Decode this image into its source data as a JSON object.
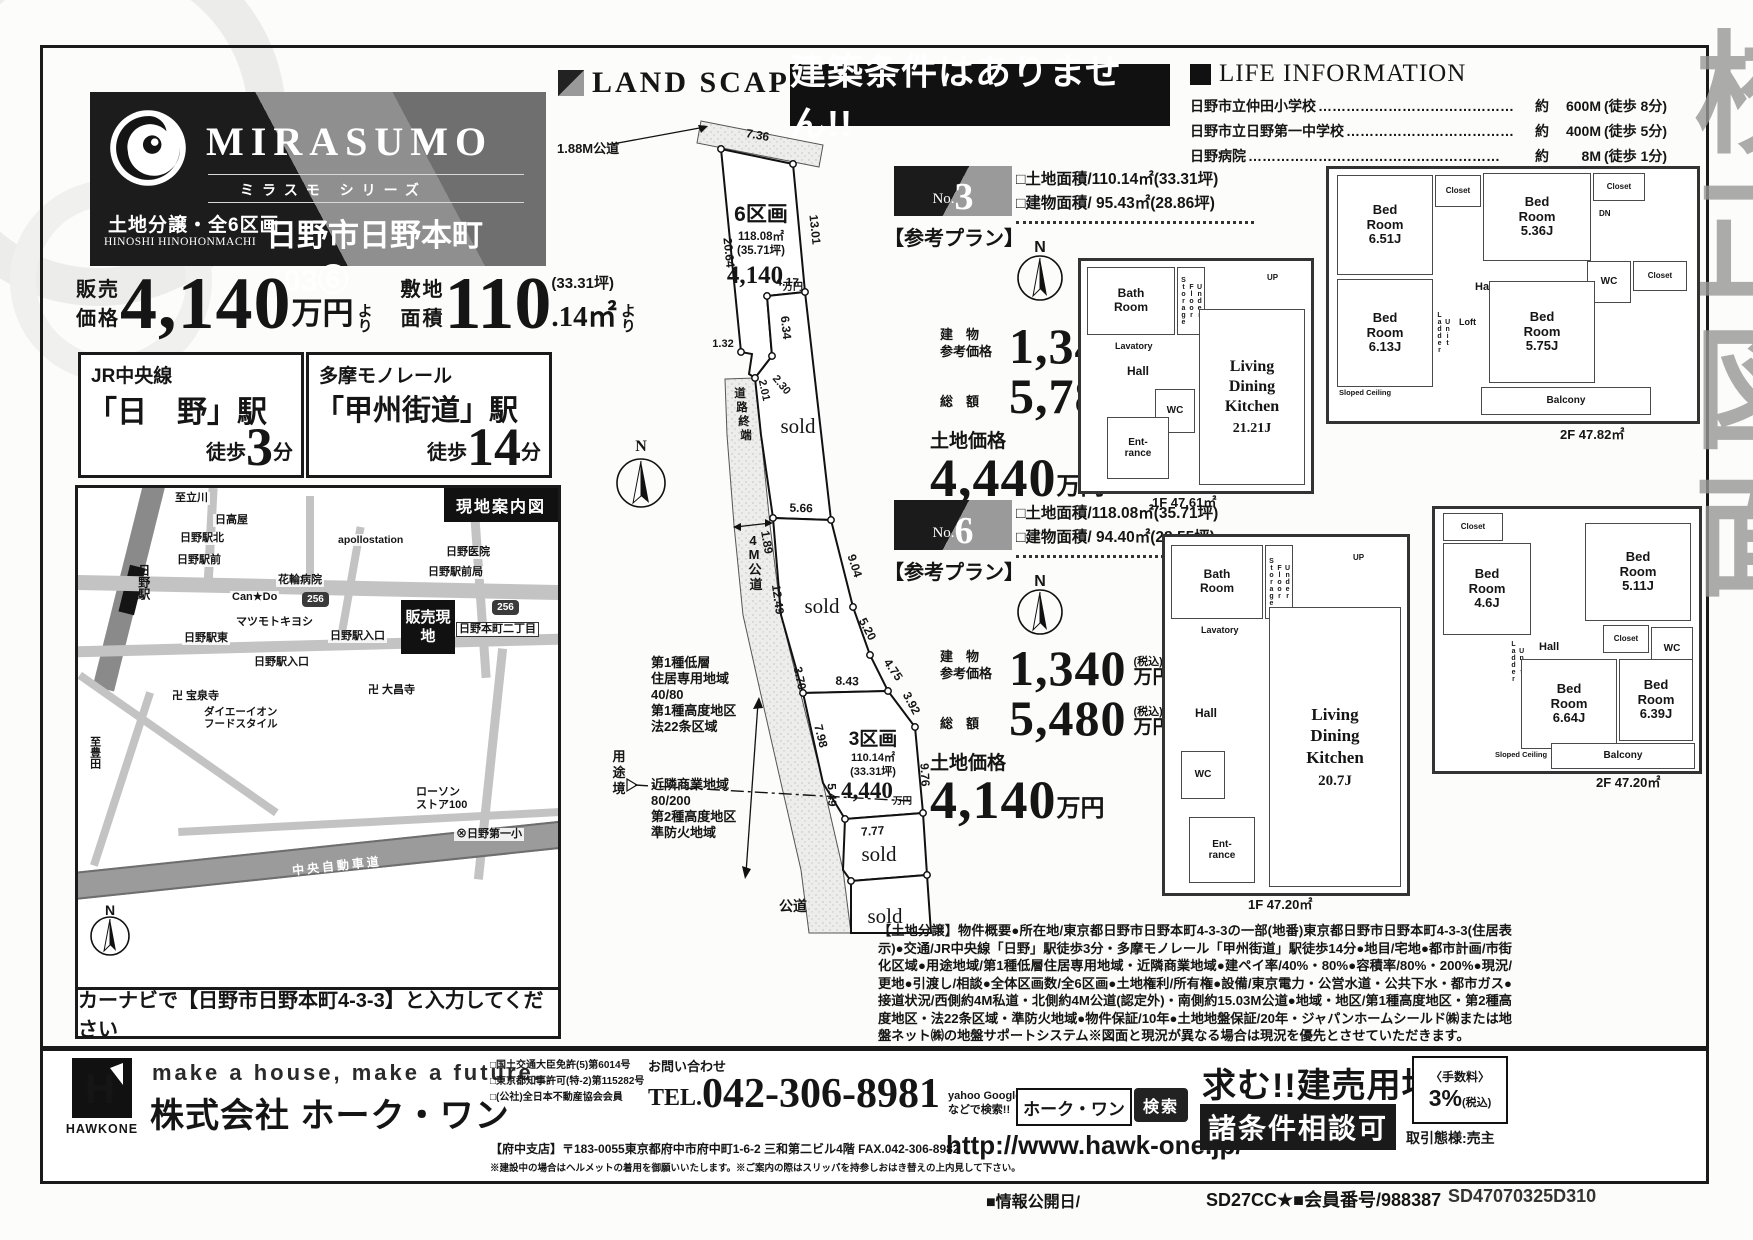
{
  "watermark": {
    "chars": [
      "校",
      "正",
      "図",
      "面"
    ]
  },
  "brand": {
    "name": "MIRASUMO",
    "series": "ミラスモ シリーズ",
    "sale_type": "土地分譲・全6区画",
    "romaji": "HINOSHI HINOHONMACHI",
    "property": "日野市日野本町403⑥"
  },
  "pricing": {
    "price_label": "販売\n価格",
    "price_value": "4,140",
    "price_unit": "万円",
    "price_suffix": "より",
    "area_label": "敷地\n面積",
    "area_value": "110",
    "area_tsubo": "(33.31坪)",
    "area_decimal": ".14㎡",
    "area_suffix": "より"
  },
  "access": [
    {
      "line": "JR中央線",
      "station": "「日　野」駅",
      "walk_prefix": "徒歩",
      "walk_num": "3",
      "walk_suffix": "分"
    },
    {
      "line": "多摩モノレール",
      "station": "「甲州街道」駅",
      "walk_prefix": "徒歩",
      "walk_num": "14",
      "walk_suffix": "分"
    }
  ],
  "map": {
    "title": "現地案内図",
    "site": "販売現地",
    "route_number": "256",
    "compass_n": "N",
    "caption": "カーナビで【日野市日野本町4-3-3】と入力してください",
    "labels": [
      "至立川",
      "日高屋",
      "日野駅北",
      "日野駅前",
      "apollostation",
      "日野医院",
      "花輪病院",
      "日野駅前局",
      "Can★Do",
      "マツモトキヨシ",
      "日野駅東",
      "日野駅入口",
      "日野本町二丁目",
      "日野駅入口",
      "卍 宝泉寺",
      "卍 大昌寺",
      "ダイエーイオン\nフードスタイル",
      "至豊田",
      "ローソン\nストア100",
      "⊗日野第一小",
      "中央自動車道",
      "日野駅"
    ]
  },
  "landscape": {
    "title": "LAND SCAPE",
    "compass_n": "N",
    "road_188": "1.88M公道",
    "road_end": [
      "道",
      "路",
      "終",
      "端"
    ],
    "road_4m": [
      "4",
      "M",
      "公",
      "道"
    ],
    "boundary": [
      "用",
      "途",
      "境"
    ],
    "public_road": "公道",
    "sold": "sold",
    "zone_north": [
      "第1種低層",
      "住居専用地域",
      "40/80",
      "第1種高度地区",
      "法22条区域"
    ],
    "zone_south": [
      "近隣商業地域",
      "80/200",
      "第2種高度地区",
      "準防火地域"
    ],
    "plot6": {
      "name": "6区画",
      "area": "118.08㎡",
      "tsubo": "(35.71坪)",
      "price": "4,140",
      "unit": "万円"
    },
    "plot3": {
      "name": "3区画",
      "area": "110.14㎡",
      "tsubo": "(33.31坪)",
      "price": "4,440",
      "unit": "万円"
    },
    "dims": {
      "d736": "7.36",
      "d2064": "20.64",
      "d1301": "13.01",
      "d417": "4.17",
      "d634": "6.34",
      "d132": "1.32",
      "d201": "2.01",
      "d230": "2.30",
      "d566": "5.66",
      "d189": "1.89",
      "d904": "9.04",
      "d1249": "12.49",
      "d520": "5.20",
      "d475": "4.75",
      "d392": "3.92",
      "d370": "3.70",
      "d843": "8.43",
      "d798": "7.98",
      "d549": "5.49",
      "d976": "9.76",
      "d777": "7.77"
    }
  },
  "banner": "建築条件はありません!!",
  "life_info": {
    "title": "LIFE INFORMATION",
    "items": [
      {
        "name": "日野市立仲田小学校",
        "dots": "……………………………………",
        "approx": "約",
        "dist": "600M",
        "walk": "(徒歩 8分)"
      },
      {
        "name": "日野市立日野第一中学校",
        "dots": "………………………………",
        "approx": "約",
        "dist": "400M",
        "walk": "(徒歩 5分)"
      },
      {
        "name": "日野病院",
        "dots": "………………………………………………",
        "approx": "約",
        "dist": "8M",
        "walk": "(徒歩 1分)"
      }
    ]
  },
  "plans": [
    {
      "no_prefix": "No.",
      "no": "3",
      "ref": "【参考プラン】",
      "land_area": "□土地面積/110.14㎡(33.31坪)",
      "building_area": "□建物面積/ 95.43㎡(28.86坪)",
      "bp_label": "建　物\n参考価格",
      "bp_value": "1,340",
      "bp_tax": "(税込)",
      "bp_unit": "万円",
      "tp_label": "総　額",
      "tp_value": "5,780",
      "tp_tax": "(税込)",
      "tp_unit": "万円",
      "lp_label": "土地価格",
      "lp_value": "4,440",
      "lp_unit": "万円",
      "f1": "1F 47.61㎡",
      "f2": "2F 47.82㎡",
      "r1": {
        "bath": "Bath\nRoom",
        "storage": "Under Floor Storage",
        "lavatory": "Lavatory",
        "hall": "Hall",
        "wc": "WC",
        "up": "UP",
        "entrance": "Ent-\nrance",
        "ldk": "Living\nDining\nKitchen",
        "ldk_size": "21.21J"
      },
      "r2": {
        "br1": "Bed\nRoom\n6.51J",
        "closet1": "Closet",
        "br2": "Bed\nRoom\n5.36J",
        "closet2": "Closet",
        "dn": "DN",
        "hall": "Hall",
        "wc": "WC",
        "closet3": "Closet",
        "br3": "Bed\nRoom\n6.13J",
        "ladder": "Unit Ladder",
        "loft": "Loft",
        "sloped": "Sloped Ceiling",
        "br4": "Bed\nRoom\n5.75J",
        "balcony": "Balcony"
      }
    },
    {
      "no_prefix": "No.",
      "no": "6",
      "ref": "【参考プラン】",
      "land_area": "□土地面積/118.08㎡(35.71坪)",
      "building_area": "□建物面積/ 94.40㎡(28.55坪)",
      "bp_label": "建　物\n参考価格",
      "bp_value": "1,340",
      "bp_tax": "(税込)",
      "bp_unit": "万円",
      "tp_label": "総　額",
      "tp_value": "5,480",
      "tp_tax": "(税込)",
      "tp_unit": "万円",
      "lp_label": "土地価格",
      "lp_value": "4,140",
      "lp_unit": "万円",
      "f1": "1F 47.20㎡",
      "f2": "2F 47.20㎡",
      "r1": {
        "bath": "Bath\nRoom",
        "storage": "Under Floor Storage",
        "lavatory": "Lavatory",
        "hall": "Hall",
        "wc": "WC",
        "up": "UP",
        "entrance": "Ent-\nrance",
        "ldk": "Living\nDining\nKitchen",
        "ldk_size": "20.7J"
      },
      "r2": {
        "closet0": "Closet",
        "br1": "Bed\nRoom\n4.6J",
        "br2": "Bed\nRoom\n5.11J",
        "hall": "Hall",
        "wc": "WC",
        "closet3": "Closet",
        "ladder": "Unit Ladder",
        "br3": "Bed\nRoom\n6.64J",
        "sloped": "Sloped Ceiling",
        "br4": "Bed\nRoom\n6.39J",
        "balcony": "Balcony"
      }
    }
  ],
  "overview": "【土地分譲】物件概要●所在地/東京都日野市日野本町4-3-3の一部(地番)東京都日野市日野本町4-3-3(住居表示)●交通/JR中央線「日野」駅徒歩3分・多摩モノレール「甲州街道」駅徒歩14分●地目/宅地●都市計画/市街化区域●用途地域/第1種低層住居専用地域・近隣商業地域●建ペイ率/40%・80%●容積率/80%・200%●現況/更地●引渡し/相談●全体区画数/全6区画●土地権利/所有権●設備/東京電力・公営水道・公共下水・都市ガス●接道状況/西側約4M私道・北側約4M公道(認定外)・南側約15.03M公道●地域・地区/第1種高度地区・第2種高度地区・法22条区域・準防火地域●物件保証/10年●土地地盤保証/20年・ジャパンホームシールド㈱または地盤ネット㈱の地盤サポートシステム※図面と現況が異なる場合は現況を優先とさせていただきます。",
  "footer": {
    "logo_text": "HAWKONE",
    "logo_h": "H",
    "tagline": "make a house, make a future.",
    "company": "株式会社 ホーク・ワン",
    "licenses": [
      "□国土交通大臣免許(5)第6014号",
      "□東京都知事許可(特-2)第115282号",
      "□(公社)全日本不動産協会会員"
    ],
    "contact_label": "お問い合わせ",
    "tel_prefix": "TEL.",
    "tel_number": "042-306-8981",
    "branch": "【府中支店】〒183-0055東京都府中市府中町1-6-2 三和第二ビル4階 FAX.042-306-8982",
    "note": "※建設中の場合はヘルメットの着用を御願いいたします。※ご案内の際はスリッパを持参しおはき替えの上内見して下さい。",
    "search_hint": "yahoo Google\nなどで検索!!",
    "search_term": "ホーク・ワン",
    "search_btn": "検索",
    "url": "http://www.hawk-one.jp/",
    "wanted": "求む!!建売用地",
    "negotiable": "諸条件相談可",
    "fee_label": "〈手数料〉",
    "fee_value": "3%",
    "fee_tax": "(税込)",
    "transaction": "取引態様:売主",
    "pub_date": "■情報公開日/",
    "member": "SD27CC★■会員番号/988387",
    "code": "SD47070325D310"
  }
}
